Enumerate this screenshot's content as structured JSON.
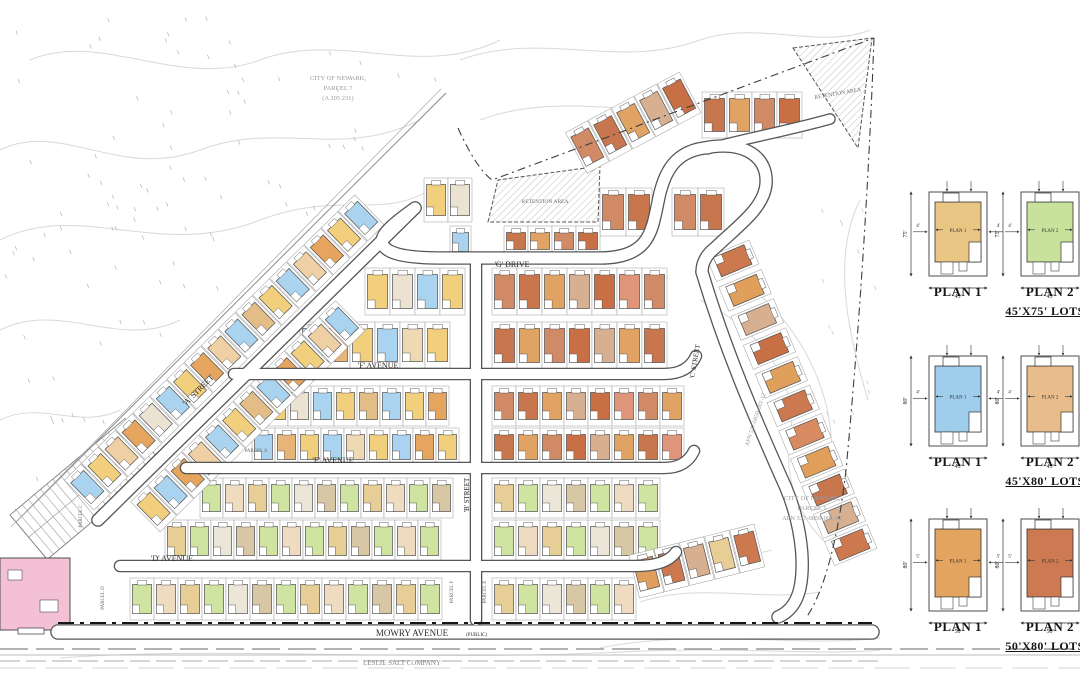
{
  "drawing": {
    "streets": {
      "g_drive": "'G' DRIVE",
      "f_avenue": "'F' AVENUE",
      "e_avenue": "'E' AVENUE",
      "d_avenue": "'D' AVENUE",
      "a_street": "'A' STREET",
      "b_street": "'B' STREET",
      "c_street": "'C' STREET",
      "mowry": "MOWRY AVENUE",
      "mowry_suffix": "(PUBLIC)"
    },
    "annotations": {
      "city_parcel_7": [
        "CITY OF NEWARK,",
        "PARCEL 7",
        "(A 205 231)"
      ],
      "city_parcel_1": [
        "CITY OF NEWARK,",
        "PARCEL 1",
        "APN 537-0850-001-02"
      ],
      "apn_diagonal": "APN 537-0850-001-12",
      "retention_area": "RETENTION AREA",
      "salt_company": "LESLIE SALT COMPANY"
    },
    "parcel_labels": [
      "PARCEL A",
      "PARCEL C",
      "PARCEL D",
      "PARCEL E",
      "PARCEL F"
    ],
    "colors": {
      "road_casing": "#565656",
      "road_fill": "#ffffff",
      "lot_line": "#9a9a9a",
      "house_line": "#4f4f4f",
      "contour": "#d9d9d9",
      "boundary": "#3d3d3d",
      "building_pink": "#f4c0d6",
      "text_gray": "#9a9a9a",
      "text_dark": "#2b2b2b"
    },
    "house_palettes": {
      "left1": [
        "#a9d3ee",
        "#f1cf7c",
        "#efd0a4",
        "#e6a55e",
        "#ece2d2",
        "#a9d3ee",
        "#f1cf7c",
        "#e6a55e",
        "#efd0a4",
        "#a9d3ee",
        "#e3bd88",
        "#f1cf7c",
        "#a9d3ee",
        "#efd0a4",
        "#e6a55e",
        "#f1cf7c",
        "#a9d3ee"
      ],
      "left2": [
        "#f1cf7c",
        "#a9d3ee",
        "#e6a55e",
        "#efd0a4",
        "#a9d3ee",
        "#f1cf7c",
        "#e3bd88",
        "#a9d3ee",
        "#e6a55e",
        "#f1cf7c",
        "#efd0a4",
        "#a9d3ee"
      ],
      "mix1": [
        "#f1cf7c",
        "#ece2d2",
        "#a9d3ee",
        "#f1cf7c",
        "#e3bd88",
        "#a9d3ee",
        "#f1cf7c",
        "#e6a55e",
        "#efd9b4",
        "#a9d3ee"
      ],
      "mix2": [
        "#a9d3ee",
        "#e8b579",
        "#f1cf7c",
        "#a9d3ee",
        "#efd9b4",
        "#f1cf7c",
        "#a9d3ee",
        "#e6a55e",
        "#f1cf7c"
      ],
      "green1": [
        "#cfe4a0",
        "#eedbc0",
        "#e7cd96",
        "#cfe4a0",
        "#ece6d9",
        "#d8c7a5",
        "#cfe4a0",
        "#e7cd96",
        "#eedbc0",
        "#cfe4a0",
        "#d8c7a5",
        "#e7cd96",
        "#cfe4a0"
      ],
      "green2": [
        "#e7cd96",
        "#cfe4a0",
        "#ece6d9",
        "#d8c7a5",
        "#cfe4a0",
        "#eedbc0",
        "#cfe4a0",
        "#e7cd96",
        "#d8c7a5",
        "#cfe4a0",
        "#eedbc0",
        "#cfe4a0"
      ],
      "red1": [
        "#d18a66",
        "#c8764e",
        "#e0a363",
        "#d7b092",
        "#c86f46",
        "#df957a",
        "#d18a66",
        "#e0a363"
      ],
      "red2": [
        "#c8764e",
        "#e0a363",
        "#d18a66",
        "#c86f46",
        "#d7b092",
        "#e0a363",
        "#c8764e",
        "#df957a"
      ],
      "east": [
        "#cc7950",
        "#e09f5b",
        "#d7b092",
        "#c86f46",
        "#e09f5b",
        "#cc7950",
        "#d88a61",
        "#e09f5b",
        "#c8764e",
        "#d7b092",
        "#cc7950"
      ],
      "mixBR": [
        "#e09f5b",
        "#cc7950",
        "#d7b092",
        "#e7cd96",
        "#cc7950"
      ]
    }
  },
  "legend": {
    "groups": [
      {
        "lot_type": "45'X75' LOTS",
        "depth": "75'",
        "width": "45'",
        "side_setback": "4'",
        "plans": [
          {
            "label": "PLAN 1",
            "color": "#eac684"
          },
          {
            "label": "PLAN 2",
            "color": "#c9e29b"
          }
        ]
      },
      {
        "lot_type": "45'X80' LOTS",
        "depth": "80'",
        "width": "45'",
        "side_setback": "4'",
        "plans": [
          {
            "label": "PLAN 1",
            "color": "#9fcdec"
          },
          {
            "label": "PLAN 2",
            "color": "#e9bd8b"
          }
        ]
      },
      {
        "lot_type": "50'X80' LOTS",
        "depth": "80'",
        "width": "50'",
        "side_setback": "5'",
        "plans": [
          {
            "label": "PLAN 1",
            "color": "#e2a45e"
          },
          {
            "label": "PLAN 2",
            "color": "#cd7a52"
          }
        ]
      }
    ]
  }
}
